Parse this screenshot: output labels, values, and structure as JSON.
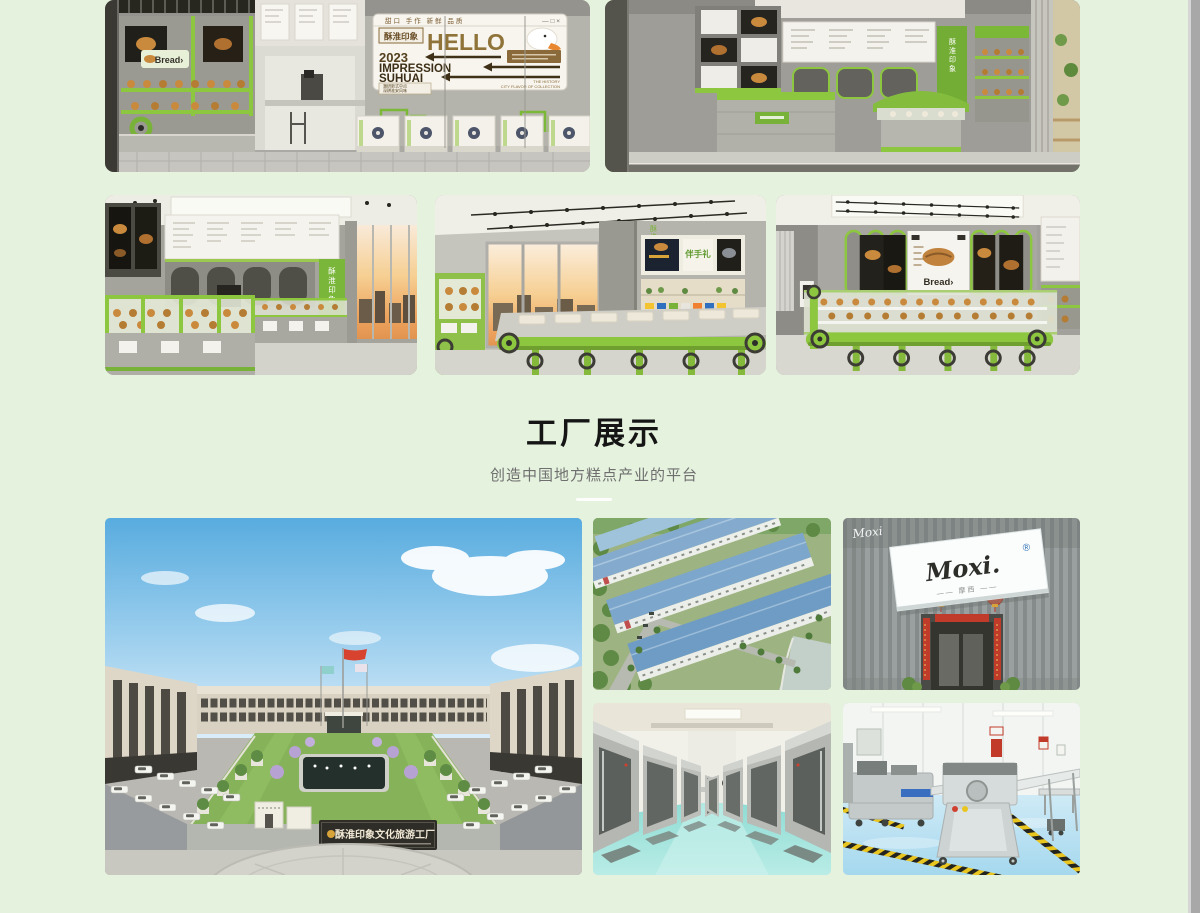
{
  "page": {
    "background": "#e5f2de",
    "accent_green": "#8dc63f"
  },
  "factory_section": {
    "title": "工厂展示",
    "subtitle": "创造中国地方糕点产业的平台"
  },
  "gallery": {
    "billboard": {
      "tabs": "甜口 手作 新鲜 品质",
      "window_controls": "— □ ×",
      "brand": "酥淮印象",
      "headline": "HELLO",
      "year": "2023",
      "impression": "IMPRESSION",
      "suhuai": "SUHUAI",
      "tagline1": "潮研新式中点",
      "tagline2": "深耕淮安风味",
      "footnote1": "THE HISTORY",
      "footnote2": "CITY FLAVOR OF COLLECTION"
    },
    "bread_sign": "Bread›",
    "vertical_brand": "酥淮印象",
    "gift_sign": "伴手礼",
    "bread_poster": "Bread›"
  },
  "factory_images": {
    "campus_sign": "酥淮印象文化旅游工厂",
    "moxi_wall_logo": "Moxi",
    "moxi_sign_logo": "Moxi.",
    "moxi_registered": "®",
    "moxi_subtitle": "—— 摩西 ——"
  }
}
